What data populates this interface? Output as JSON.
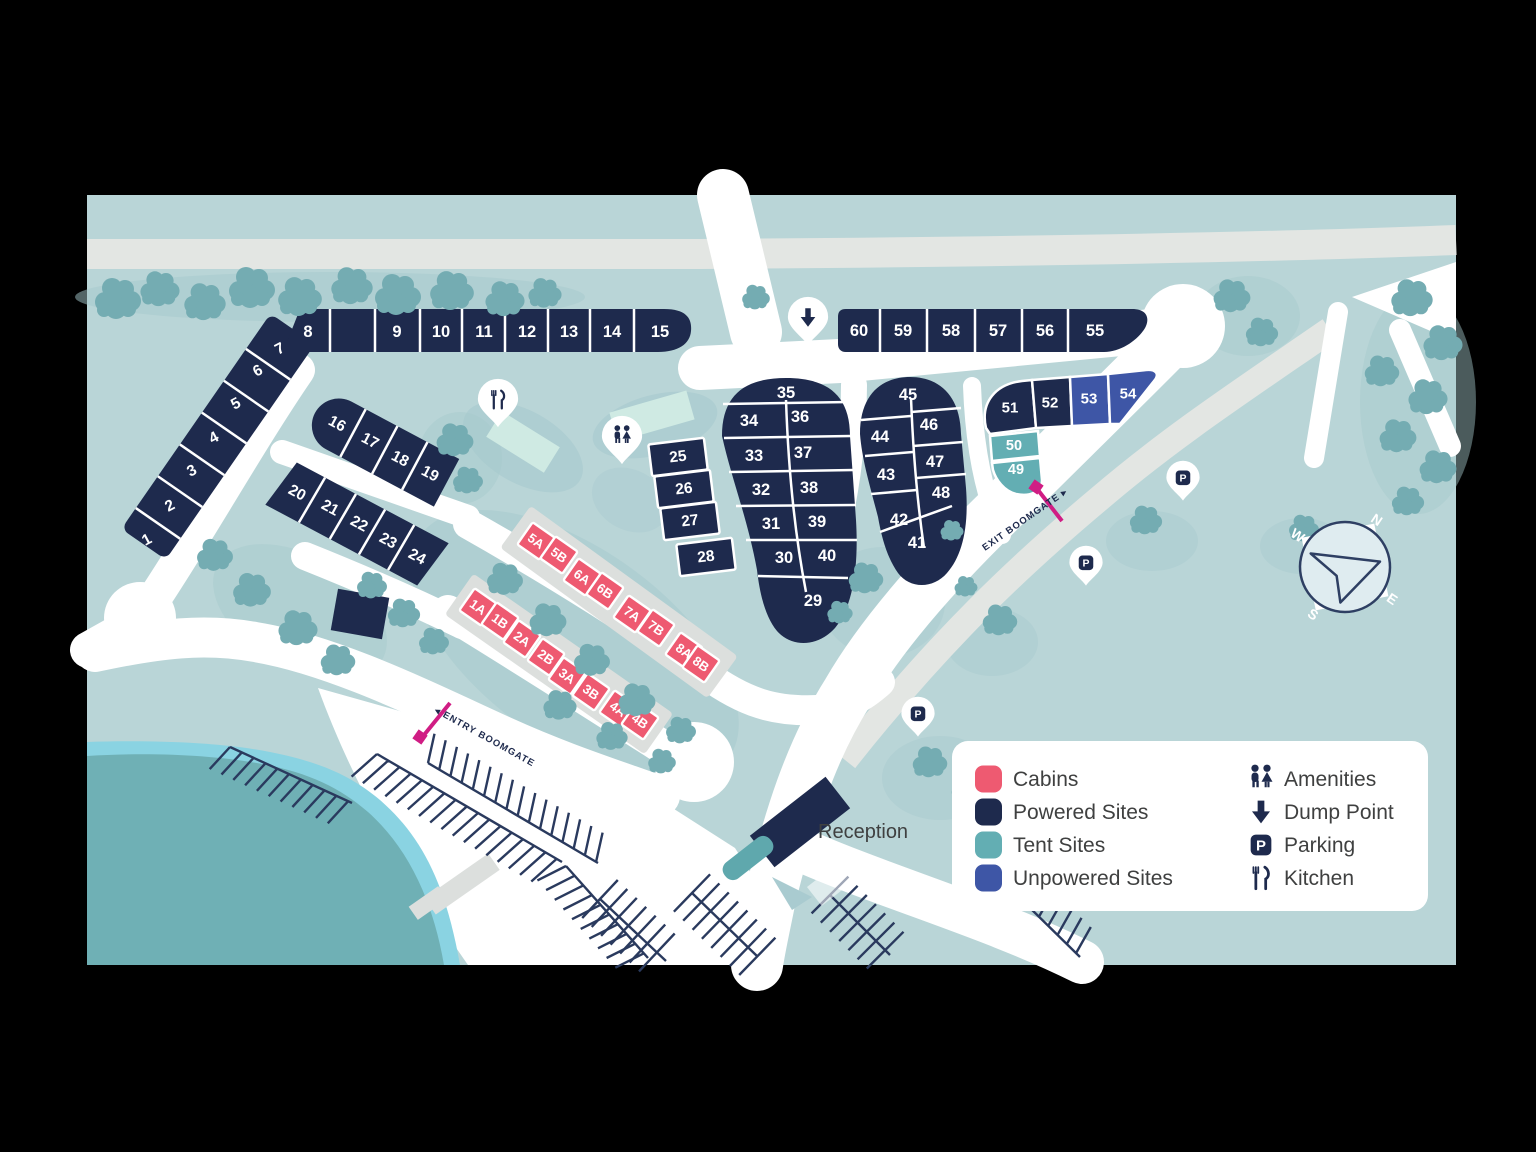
{
  "colors": {
    "cabins": "#EE5A71",
    "powered_sites": "#1E2A4D",
    "tent_sites": "#63AEB3",
    "unpowered_sites": "#3E56A6",
    "background": "#B9D5D7",
    "road_white": "#FFFFFF",
    "road_gray": "#E3E6E3",
    "tree": "#74ACB2",
    "lake": "#6FB0B5",
    "lake_edge": "#8AD3E2",
    "building_light": "#CFEAE3",
    "boomgate": "#D01D84",
    "navy_icon": "#1E2A4D",
    "label_text": "#3F4040",
    "parking_lines": "#2A3A5E"
  },
  "icons": {
    "parking_glyph": "P"
  },
  "labels": {
    "reception": "Reception",
    "entry_boomgate": "◂ ENTRY BOOMGATE",
    "exit_boomgate": "EXIT BOOMGATE ▸"
  },
  "compass": {
    "n": "N",
    "e": "E",
    "s": "S",
    "w": "W"
  },
  "legend": {
    "left": [
      {
        "key": "cabins",
        "label": "Cabins"
      },
      {
        "key": "powered_sites",
        "label": "Powered Sites"
      },
      {
        "key": "tent_sites",
        "label": "Tent Sites"
      },
      {
        "key": "unpowered_sites",
        "label": "Unpowered Sites"
      }
    ],
    "right": [
      {
        "icon": "amenities",
        "label": "Amenities"
      },
      {
        "icon": "dump",
        "label": "Dump Point"
      },
      {
        "icon": "parking",
        "label": "Parking"
      },
      {
        "icon": "kitchen",
        "label": "Kitchen"
      }
    ]
  },
  "sites": [
    {
      "l": "1",
      "x": 147,
      "y": 540,
      "r": -28,
      "fs": 15.5
    },
    {
      "l": "2",
      "x": 170,
      "y": 506,
      "r": -28,
      "fs": 15.5
    },
    {
      "l": "3",
      "x": 192,
      "y": 471,
      "r": -28,
      "fs": 15.5
    },
    {
      "l": "4",
      "x": 214,
      "y": 438,
      "r": -28,
      "fs": 15.5
    },
    {
      "l": "5",
      "x": 236,
      "y": 404,
      "r": -28,
      "fs": 15.5
    },
    {
      "l": "6",
      "x": 258,
      "y": 371,
      "r": -28,
      "fs": 15.5
    },
    {
      "l": "7",
      "x": 280,
      "y": 349,
      "r": -28,
      "fs": 15.5
    },
    {
      "l": "8",
      "x": 308,
      "y": 332
    },
    {
      "l": "9",
      "x": 397,
      "y": 332
    },
    {
      "l": "10",
      "x": 441,
      "y": 332
    },
    {
      "l": "11",
      "x": 484,
      "y": 332
    },
    {
      "l": "12",
      "x": 527,
      "y": 332
    },
    {
      "l": "13",
      "x": 569,
      "y": 332
    },
    {
      "l": "14",
      "x": 612,
      "y": 332
    },
    {
      "l": "15",
      "x": 660,
      "y": 332
    },
    {
      "l": "16",
      "x": 337,
      "y": 424,
      "r": 28,
      "fs": 15.5
    },
    {
      "l": "17",
      "x": 370,
      "y": 441,
      "r": 28,
      "fs": 15.5
    },
    {
      "l": "18",
      "x": 400,
      "y": 459,
      "r": 28,
      "fs": 15.5
    },
    {
      "l": "19",
      "x": 430,
      "y": 474,
      "r": 28,
      "fs": 15.5
    },
    {
      "l": "20",
      "x": 297,
      "y": 493,
      "r": 28,
      "fs": 15.5
    },
    {
      "l": "21",
      "x": 330,
      "y": 508,
      "r": 28,
      "fs": 15.5
    },
    {
      "l": "22",
      "x": 359,
      "y": 524,
      "r": 28,
      "fs": 15.5
    },
    {
      "l": "23",
      "x": 388,
      "y": 541,
      "r": 28,
      "fs": 15.5
    },
    {
      "l": "24",
      "x": 417,
      "y": 557,
      "r": 28,
      "fs": 15.5
    },
    {
      "l": "25",
      "x": 678,
      "y": 457,
      "r": -7,
      "fs": 15.5
    },
    {
      "l": "26",
      "x": 684,
      "y": 489,
      "r": -7,
      "fs": 15.5
    },
    {
      "l": "27",
      "x": 690,
      "y": 521,
      "r": -7,
      "fs": 15.5
    },
    {
      "l": "28",
      "x": 706,
      "y": 557,
      "r": -7,
      "fs": 15.5
    },
    {
      "l": "29",
      "x": 813,
      "y": 601
    },
    {
      "l": "30",
      "x": 784,
      "y": 558
    },
    {
      "l": "31",
      "x": 771,
      "y": 524
    },
    {
      "l": "32",
      "x": 761,
      "y": 490
    },
    {
      "l": "33",
      "x": 754,
      "y": 456
    },
    {
      "l": "34",
      "x": 749,
      "y": 421
    },
    {
      "l": "35",
      "x": 786,
      "y": 393
    },
    {
      "l": "36",
      "x": 800,
      "y": 417
    },
    {
      "l": "37",
      "x": 803,
      "y": 453
    },
    {
      "l": "38",
      "x": 809,
      "y": 488
    },
    {
      "l": "39",
      "x": 817,
      "y": 522
    },
    {
      "l": "40",
      "x": 827,
      "y": 556
    },
    {
      "l": "41",
      "x": 917,
      "y": 543
    },
    {
      "l": "42",
      "x": 899,
      "y": 520
    },
    {
      "l": "43",
      "x": 886,
      "y": 475
    },
    {
      "l": "44",
      "x": 880,
      "y": 437
    },
    {
      "l": "45",
      "x": 908,
      "y": 395
    },
    {
      "l": "46",
      "x": 929,
      "y": 425
    },
    {
      "l": "47",
      "x": 935,
      "y": 462
    },
    {
      "l": "48",
      "x": 941,
      "y": 493
    },
    {
      "l": "49",
      "x": 1016,
      "y": 470,
      "t": "tent",
      "fs": 14.5
    },
    {
      "l": "50",
      "x": 1014,
      "y": 446,
      "t": "tent",
      "fs": 14.5
    },
    {
      "l": "51",
      "x": 1010,
      "y": 408,
      "fs": 15
    },
    {
      "l": "52",
      "x": 1050,
      "y": 403,
      "fs": 15
    },
    {
      "l": "53",
      "x": 1089,
      "y": 399,
      "t": "unpowered",
      "fs": 15
    },
    {
      "l": "54",
      "x": 1128,
      "y": 394,
      "t": "unpowered",
      "fs": 15
    },
    {
      "l": "55",
      "x": 1095,
      "y": 331
    },
    {
      "l": "56",
      "x": 1045,
      "y": 331
    },
    {
      "l": "57",
      "x": 998,
      "y": 331
    },
    {
      "l": "58",
      "x": 951,
      "y": 331
    },
    {
      "l": "59",
      "x": 903,
      "y": 331
    },
    {
      "l": "60",
      "x": 859,
      "y": 331
    }
  ],
  "cabins": [
    {
      "l": "1A",
      "x": 478,
      "y": 607
    },
    {
      "l": "1B",
      "x": 500,
      "y": 621
    },
    {
      "l": "2A",
      "x": 522,
      "y": 639
    },
    {
      "l": "2B",
      "x": 546,
      "y": 657
    },
    {
      "l": "3A",
      "x": 567,
      "y": 676
    },
    {
      "l": "3B",
      "x": 591,
      "y": 692
    },
    {
      "l": "4A",
      "x": 618,
      "y": 709
    },
    {
      "l": "4B",
      "x": 640,
      "y": 721
    },
    {
      "l": "5A",
      "x": 536,
      "y": 541
    },
    {
      "l": "5B",
      "x": 559,
      "y": 555
    },
    {
      "l": "6A",
      "x": 582,
      "y": 577
    },
    {
      "l": "6B",
      "x": 605,
      "y": 591
    },
    {
      "l": "7A",
      "x": 632,
      "y": 614
    },
    {
      "l": "7B",
      "x": 656,
      "y": 628
    },
    {
      "l": "8A",
      "x": 684,
      "y": 651
    },
    {
      "l": "8B",
      "x": 701,
      "y": 664
    }
  ],
  "pins": [
    {
      "type": "kitchen",
      "x": 498,
      "y": 407
    },
    {
      "type": "amenities",
      "x": 622,
      "y": 444
    },
    {
      "type": "dump",
      "x": 808,
      "y": 325
    },
    {
      "type": "parking",
      "x": 1183,
      "y": 484
    },
    {
      "type": "parking",
      "x": 1086,
      "y": 569
    },
    {
      "type": "parking",
      "x": 918,
      "y": 720
    }
  ]
}
